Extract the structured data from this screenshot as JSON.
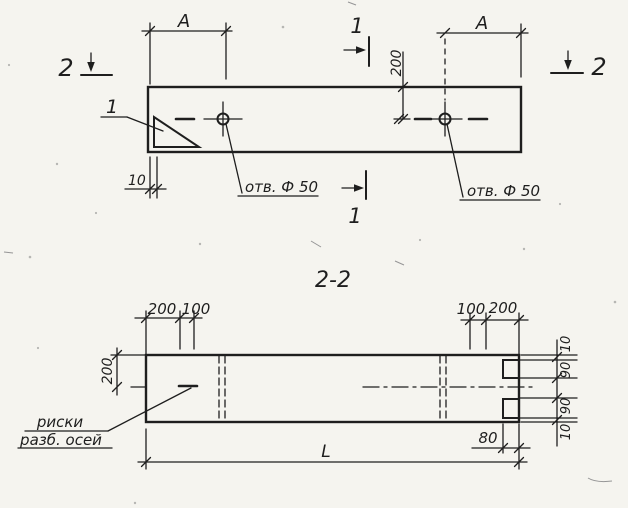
{
  "colors": {
    "ink": "#1e1e1e",
    "paper": "#f5f4ef"
  },
  "top_view": {
    "dim_a_left": "A",
    "dim_a_right": "A",
    "dim_hole_offset": "200",
    "dim_edge": "10",
    "hole_note_left": "отв. Ф 50",
    "hole_note_right": "отв. Ф 50",
    "callout": "1",
    "section_1_label_top": "1",
    "section_1_label_bottom": "1",
    "section_2_label_left": "2",
    "section_2_label_right": "2"
  },
  "section_view": {
    "title": "2-2",
    "dim_left_outer": "200",
    "dim_left_inner": "100",
    "dim_right_inner": "100",
    "dim_right_outer": "200",
    "dim_height_half": "200",
    "dim_chain": [
      "10",
      "90",
      "90",
      "10"
    ],
    "dim_notch": "80",
    "dim_length": "L",
    "axis_note_line1": "риски",
    "axis_note_line2": "разб. осей"
  }
}
